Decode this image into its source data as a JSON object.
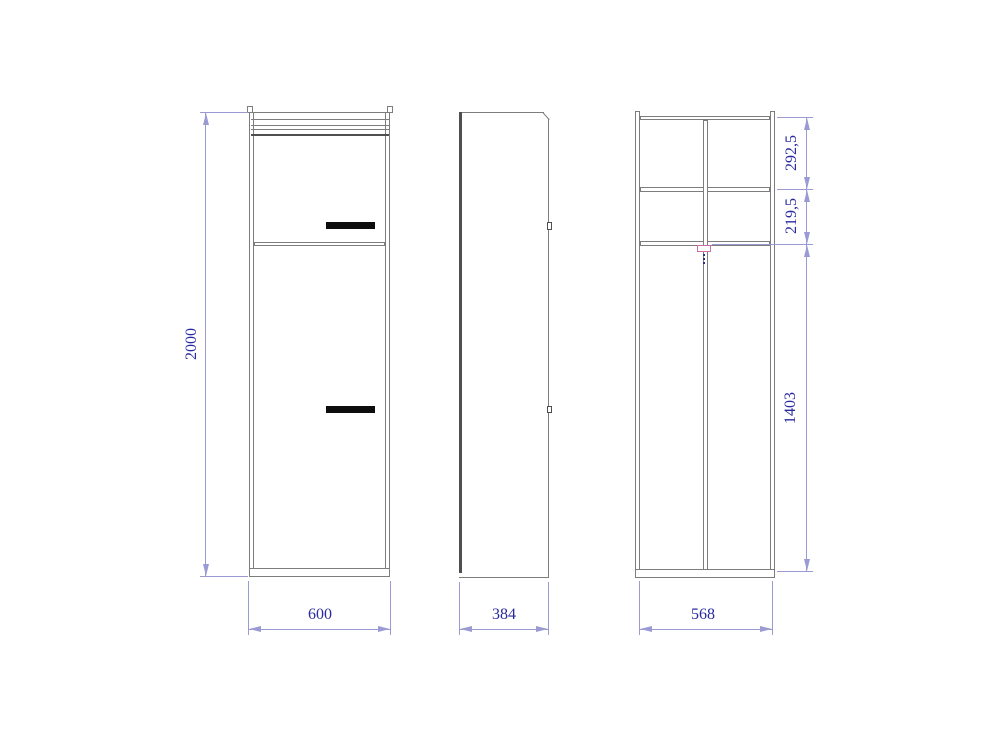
{
  "dimensions": {
    "overall_height": "2000",
    "front_width": "600",
    "side_depth": "384",
    "carcass_width": "568",
    "upper_section_height": "292,5",
    "middle_section_height": "219,5",
    "lower_section_height": "1403"
  },
  "colors": {
    "background": "#ffffff",
    "outline": "#7d7d7d",
    "outline_dark": "#4f4f4f",
    "dimension_line": "#9a9ad4",
    "dimension_text": "#2a2aa0",
    "handle": "#0d0d0d",
    "bracket": "#cc6fa3"
  }
}
